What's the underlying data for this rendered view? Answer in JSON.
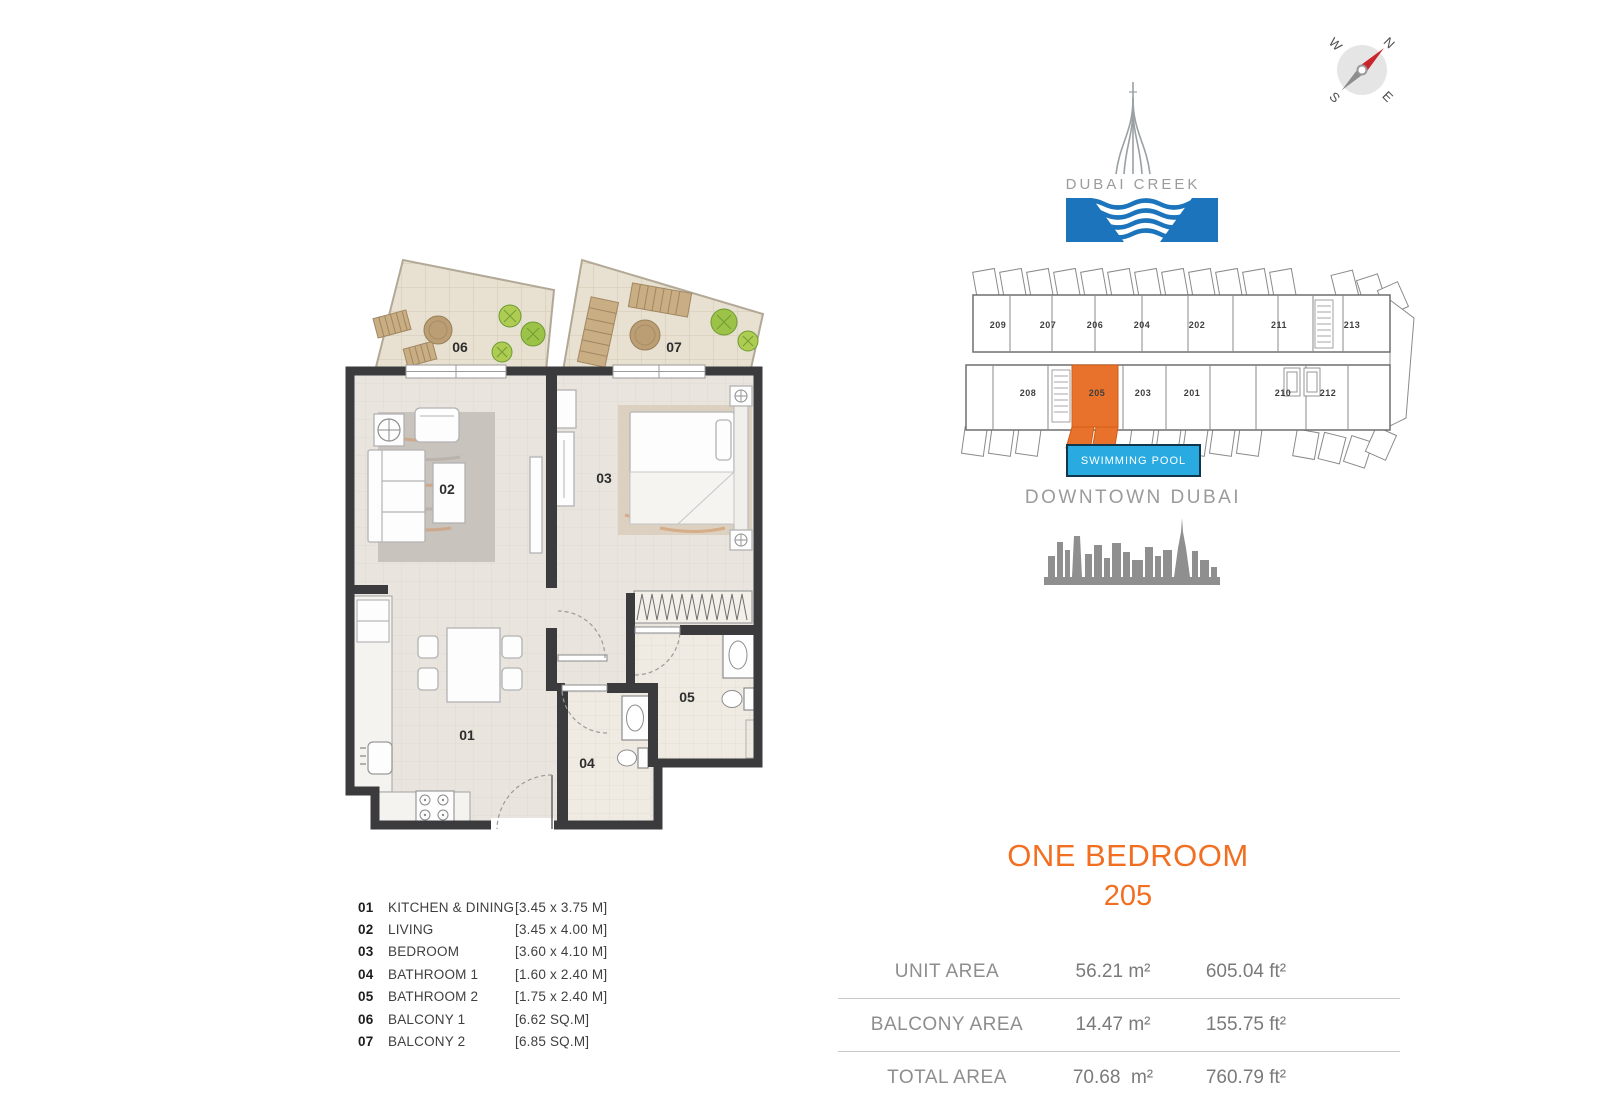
{
  "compass": {
    "n": "N",
    "e": "E",
    "s": "S",
    "w": "W"
  },
  "brand": {
    "name": "DUBAI CREEK",
    "text_color": "#9B9B9B",
    "water_color": "#1C75BC",
    "tower_color": "#9AA0A3",
    "tower_icon": "dubai-creek-tower-icon",
    "water_icon": "creek-water-waves-icon"
  },
  "keyplan": {
    "top_units": [
      "209",
      "207",
      "206",
      "204",
      "202",
      "211",
      "213"
    ],
    "bottom_units": [
      "208",
      "205",
      "203",
      "201",
      "210",
      "212"
    ],
    "highlighted_unit": "205",
    "highlight_color": "#E8722C"
  },
  "pool": {
    "label": "SWIMMING POOL",
    "bg": "#29ABE2",
    "border": "#10364C",
    "text_color": "#FFFFFF"
  },
  "downtown": {
    "label": "DOWNTOWN DUBAI",
    "skyline_color": "#8F8F8F",
    "skyline_icon": "downtown-dubai-skyline-icon"
  },
  "unit": {
    "type_title": "ONE BEDROOM",
    "number": "205",
    "accent": "#F26F21"
  },
  "areas": {
    "rows": [
      {
        "label": "UNIT AREA",
        "metric": "56.21 m²",
        "imperial": "605.04 ft²"
      },
      {
        "label": "BALCONY AREA",
        "metric": "14.47 m²",
        "imperial": "155.75 ft²"
      },
      {
        "label": "TOTAL AREA",
        "metric": "70.68  m²",
        "imperial": "760.79 ft²"
      }
    ]
  },
  "legend": {
    "items": [
      {
        "num": "01",
        "name": "KITCHEN & DINING",
        "dim": "[3.45 x 3.75 M]"
      },
      {
        "num": "02",
        "name": "LIVING",
        "dim": "[3.45 x 4.00 M]"
      },
      {
        "num": "03",
        "name": "BEDROOM",
        "dim": "[3.60 x 4.10 M]"
      },
      {
        "num": "04",
        "name": "BATHROOM 1",
        "dim": "[1.60 x 2.40 M]"
      },
      {
        "num": "05",
        "name": "BATHROOM 2",
        "dim": "[1.75 x 2.40 M]"
      },
      {
        "num": "06",
        "name": "BALCONY 1",
        "dim": "[6.62 SQ.M]"
      },
      {
        "num": "07",
        "name": "BALCONY 2",
        "dim": "[6.85 SQ.M]"
      }
    ]
  },
  "floorplan": {
    "rooms": [
      "01",
      "02",
      "03",
      "04",
      "05",
      "06",
      "07"
    ],
    "wall_color": "#3B3B3E"
  }
}
